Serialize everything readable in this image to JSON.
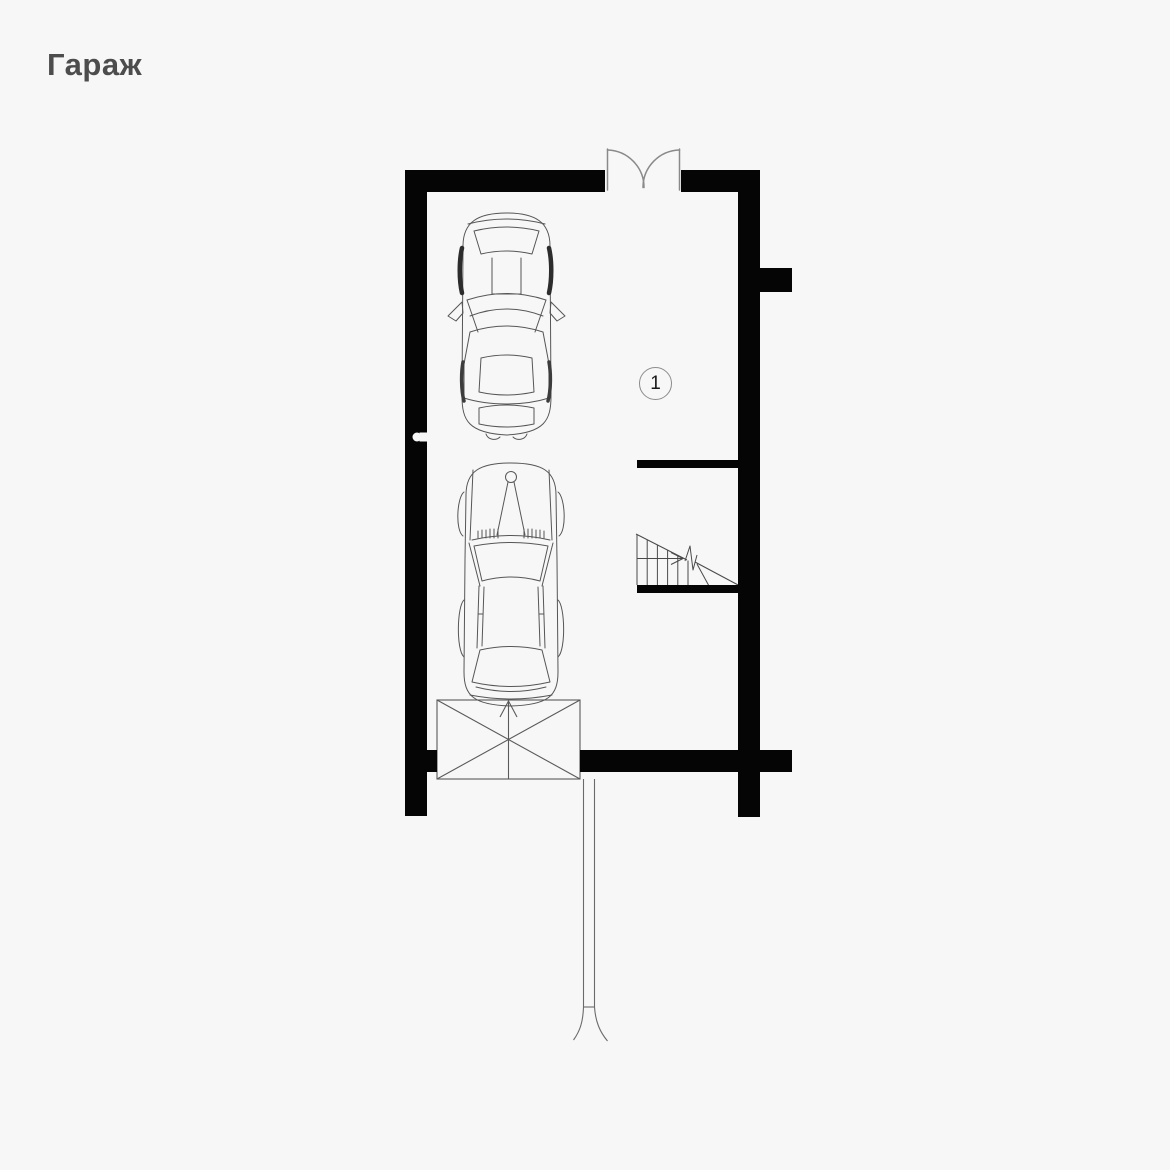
{
  "page": {
    "title": "Гараж",
    "background_color": "#f7f7f7",
    "title_color": "#4d4d4d"
  },
  "plan": {
    "room_label": "1",
    "wall_color": "#050505",
    "line_color": "#4a4a4a",
    "door_arc_color": "#8a8a8a",
    "elements": {
      "entry_door": "double-swing-door-icon",
      "staircase": "staircase-with-up-arrow-icon",
      "stair_break": "break-line-icon",
      "garage_door": "garage-door-x-panel-icon",
      "vehicles": [
        "car-suv-top-view-icon",
        "car-sedan-top-view-icon"
      ],
      "driveway": "driveway-path-icon",
      "wall_marker": "wall-sleeve-icon"
    }
  }
}
